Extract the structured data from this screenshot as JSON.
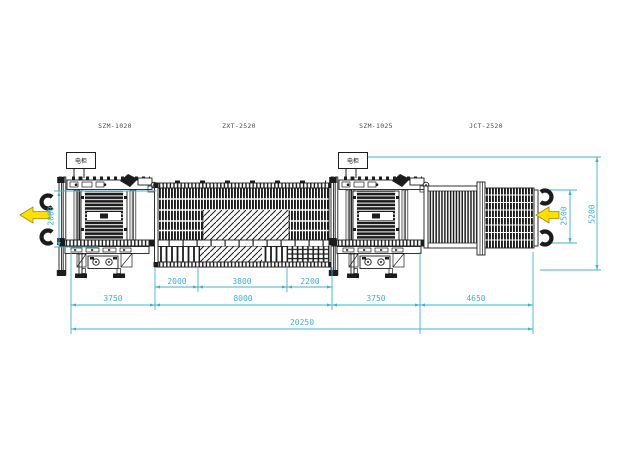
{
  "labels": {
    "machine_left": "SZM-1020",
    "conveyor_mid": "ZXT-2520",
    "machine_mid": "SZM-1025",
    "conveyor_right": "JCT-2520",
    "cabinet": "电柜"
  },
  "dimensions": {
    "left_height": "2000",
    "right_height": "2500",
    "total_height": "5200",
    "seg_2000": "2000",
    "seg_3800": "3800",
    "seg_2200": "2200",
    "left_span": "3750",
    "mid_span": "8000",
    "right_span": "3750",
    "far_right_span": "4650",
    "total_length": "20250"
  },
  "colors": {
    "dimension": "#3fb1d0",
    "ink": "#1c1c1c",
    "arrow_fill": "#ffdf00",
    "arrow_outline": "#a08a00",
    "label_text": "#4d4d4d",
    "background": "#ffffff"
  }
}
